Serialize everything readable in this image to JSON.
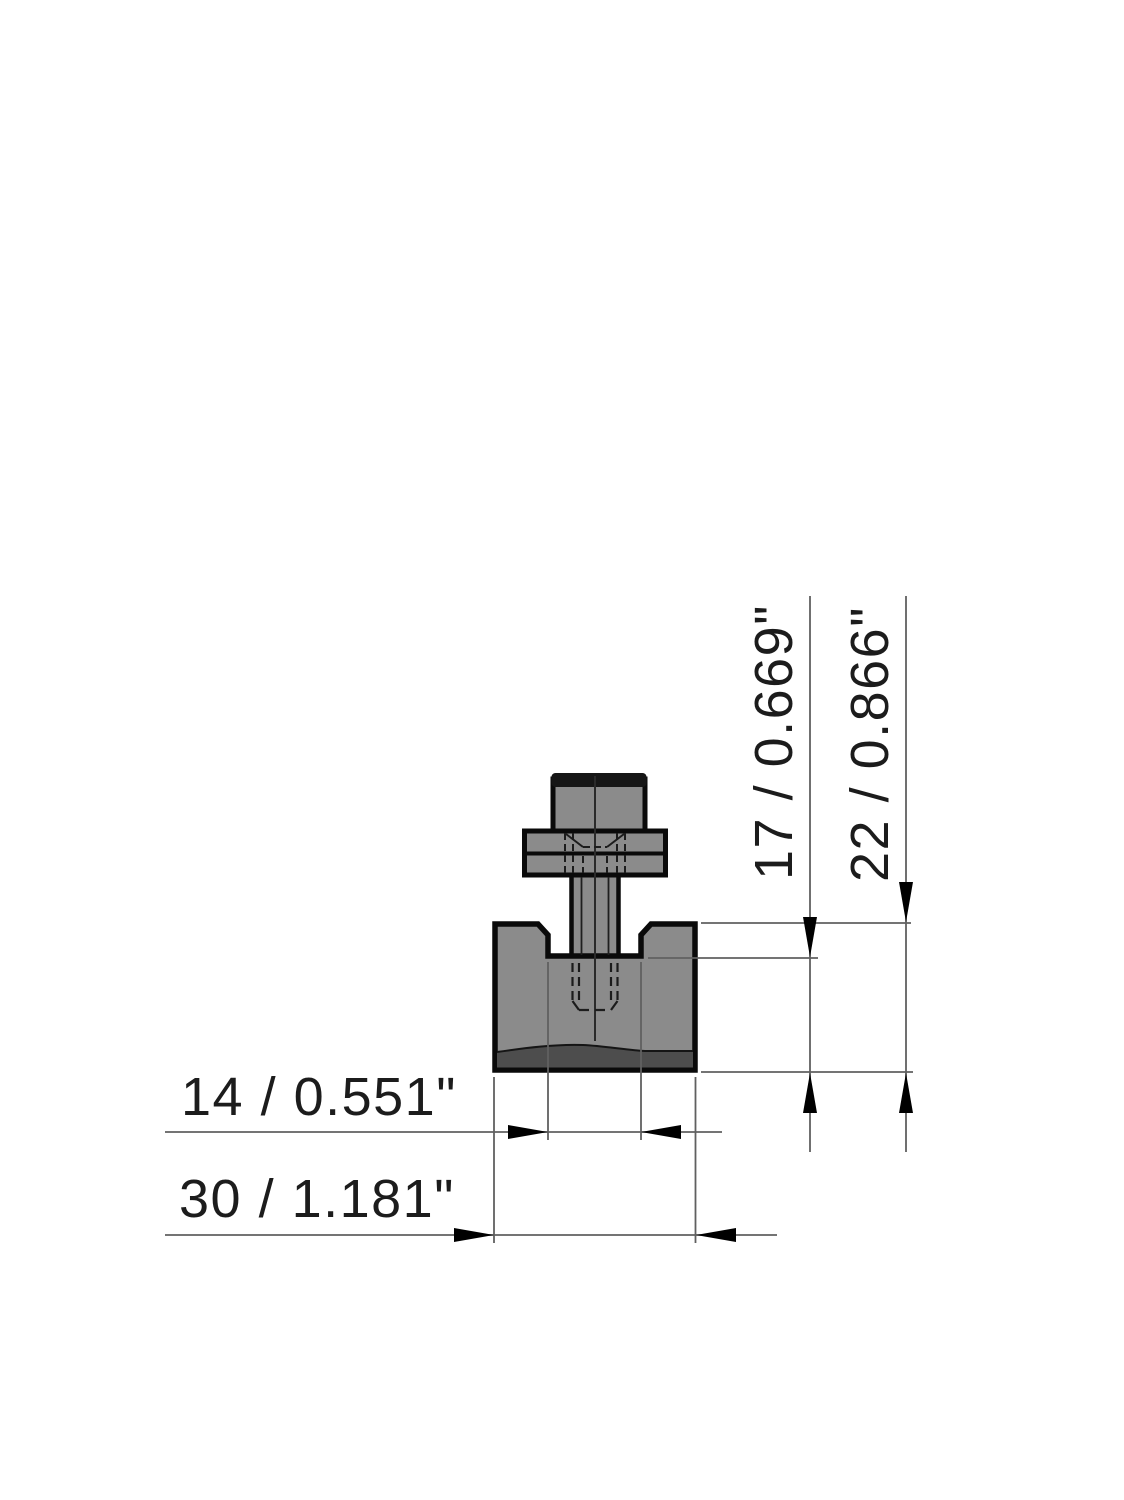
{
  "drawing": {
    "kind": "technical dimension drawing of T-slot block with bolt and washer",
    "dims": {
      "d14": {
        "label": "14 / 0.551\"",
        "value_mm": "14",
        "value_inch": "0.551\"",
        "orientation": "horizontal",
        "measures": "slot width"
      },
      "d30": {
        "label": "30 / 1.181\"",
        "value_mm": "30",
        "value_inch": "1.181\"",
        "orientation": "horizontal",
        "measures": "overall width"
      },
      "d17": {
        "label": "17 / 0.669\"",
        "value_mm": "17",
        "value_inch": "0.669\"",
        "orientation": "vertical",
        "measures": "height below slot bottom"
      },
      "d22": {
        "label": "22 / 0.866\"",
        "value_mm": "22",
        "value_inch": "0.866\"",
        "orientation": "vertical",
        "measures": "overall block height"
      }
    },
    "colors": {
      "background": "#FFFFFF",
      "part_fill": "#8B8B8B",
      "part_dark_band": "#4D4D4D",
      "bolt_head_cap": "#161616",
      "outline": "#0A0A0A",
      "dimension_line": "#606060",
      "arrow": "#000000",
      "text": "#1C1C1C"
    }
  }
}
